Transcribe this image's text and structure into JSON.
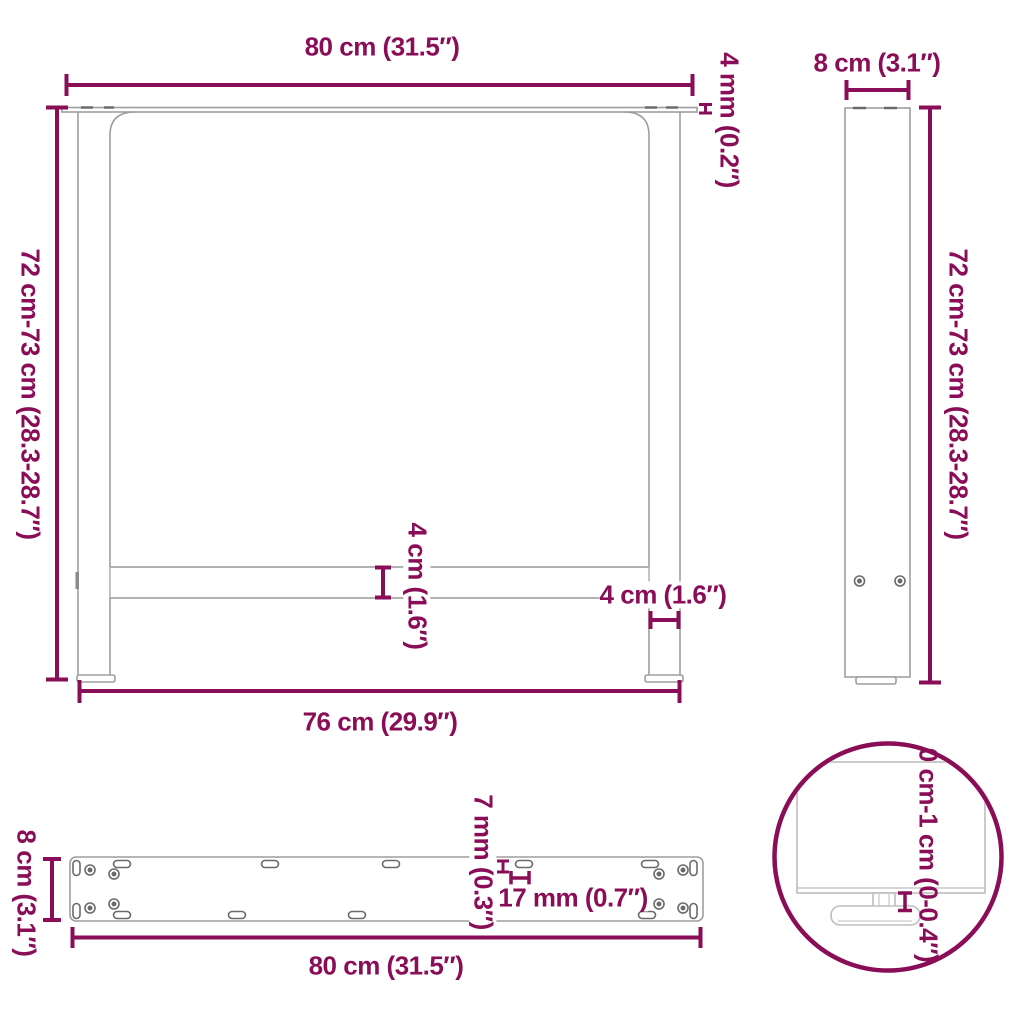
{
  "diagram": {
    "type": "furniture-dimension-diagram",
    "subject": "table-legs",
    "colors": {
      "dimension_accent": "#8a0e57",
      "outline_gray": "#9e9e9e",
      "detail_gray": "#6a6a6a",
      "light_gray": "#bdbdbd",
      "background": "#ffffff"
    },
    "views": {
      "front": {
        "top_width": "80 cm (31.5″)",
        "plate_thickness": "4 mm (0.2″)",
        "height": "72 cm-73 cm (28.3-28.7″)",
        "crossbar_height": "4 cm (1.6″)",
        "leg_width": "4 cm (1.6″)",
        "bottom_width": "76 cm (29.9″)"
      },
      "side": {
        "depth": "8 cm (3.1″)",
        "height": "72 cm-73 cm (28.3-28.7″)"
      },
      "plate": {
        "depth": "8 cm (3.1″)",
        "slot_width": "7 mm (0.3″)",
        "slot_length": "17 mm (0.7″)",
        "width": "80 cm (31.5″)"
      },
      "detail": {
        "foot_adjust_range": "0 cm-1 cm (0-0.4″)"
      }
    }
  }
}
